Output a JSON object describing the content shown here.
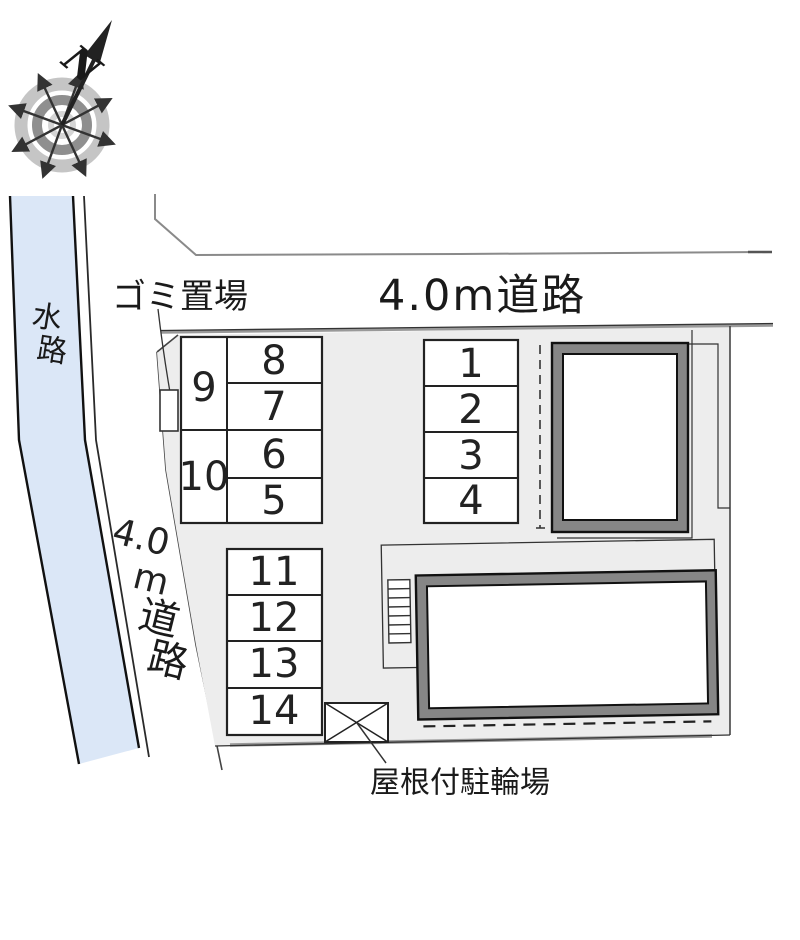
{
  "plan": {
    "compass": {
      "north_label": "N"
    },
    "labels": {
      "waterway_char_1": "水",
      "waterway_char_2": "路",
      "road_top": "4.0m道路",
      "road_left_part_1": "4.0",
      "road_left_part_2": "m",
      "road_left_part_3": "道",
      "road_left_part_4": "路",
      "garbage_area": "ゴミ置場",
      "bike_shed": "屋根付駐輪場"
    },
    "parking": {
      "block_a_left": [
        "9",
        "10"
      ],
      "block_a_right": [
        "8",
        "7",
        "6",
        "5"
      ],
      "block_b": [
        "1",
        "2",
        "3",
        "4"
      ],
      "block_c": [
        "11",
        "12",
        "13",
        "14"
      ]
    },
    "colors": {
      "waterway": "#dbe7f7",
      "parcel": "#ededed",
      "building_wall": "#868686",
      "building_interior": "#ffffff",
      "outline": "#1a1a1a",
      "road_line": "#8a8a8a"
    }
  }
}
